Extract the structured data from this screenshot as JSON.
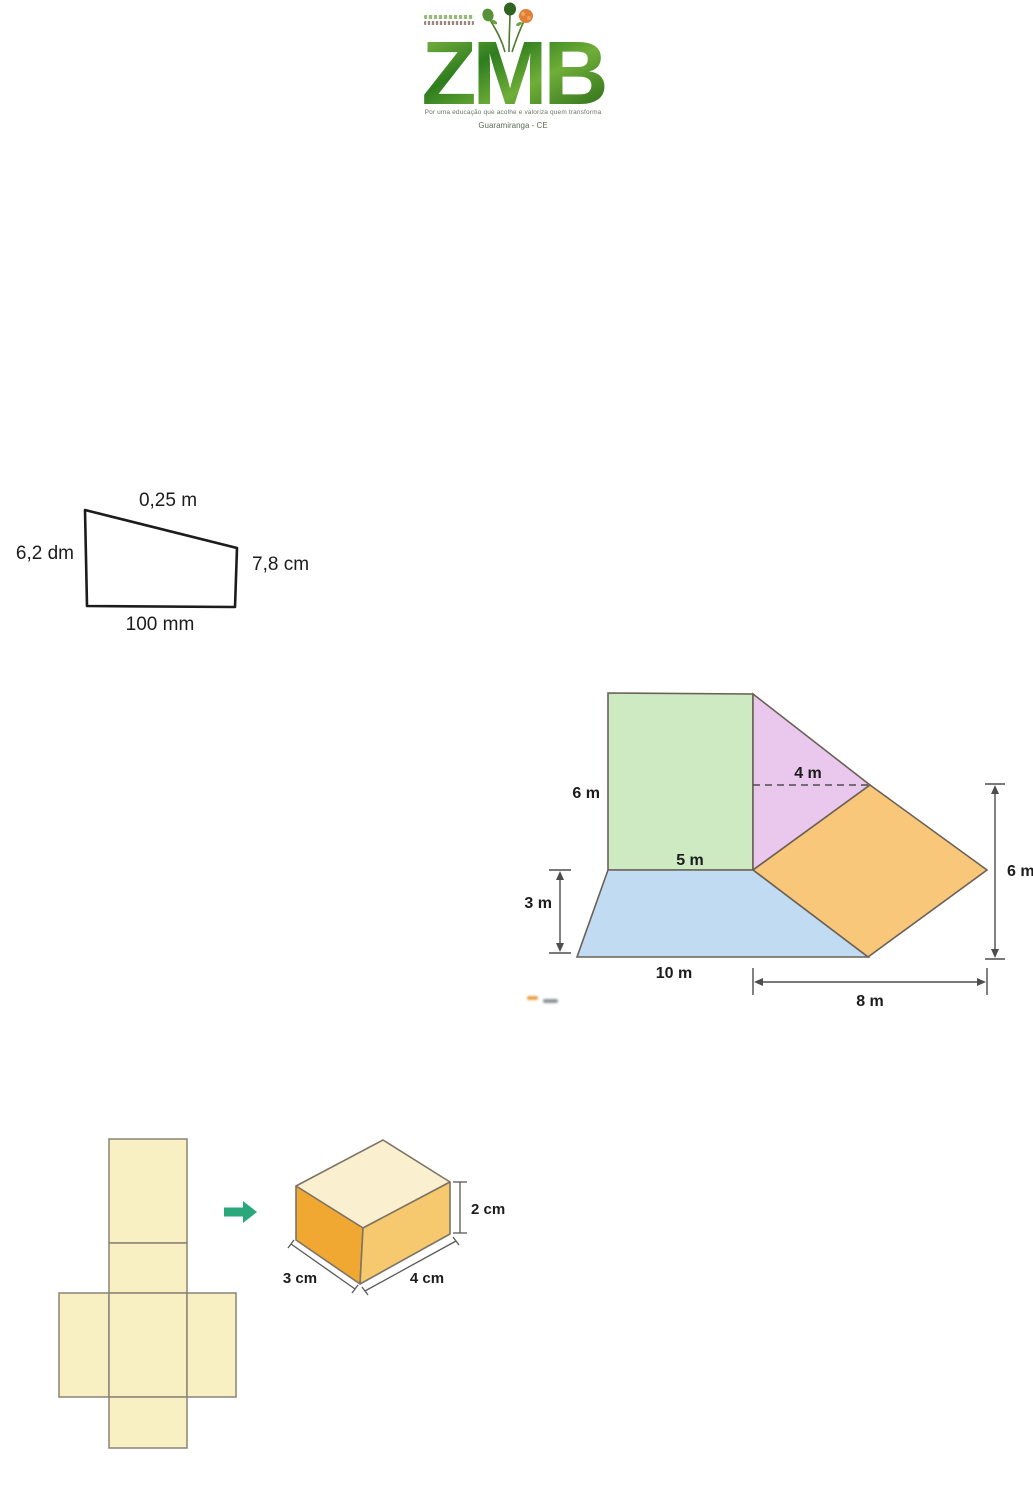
{
  "logo": {
    "name": "ZMB",
    "tagline": "Por uma educação que acolhe e valoriza quem transforma",
    "location": "Guaramiranga - CE"
  },
  "trapezoid_figure": {
    "side_top": "0,25 m",
    "side_left": "6,2 dm",
    "side_right": "7,8 cm",
    "side_bottom": "100 mm"
  },
  "composite_figure": {
    "square_height": "6 m",
    "square_base": "5 m",
    "triangle_width": "4 m",
    "trapezoid_height": "3 m",
    "trapezoid_base": "10 m",
    "right_height": "6 m",
    "bottom_width": "8 m",
    "colors": {
      "square": "#cdeac3",
      "triangle": "#eac7ed",
      "parallelogram": "#f9c77a",
      "trapezoid": "#c1dcf2"
    }
  },
  "net_figure": {
    "box_height": "2 cm",
    "box_depth": "3 cm",
    "box_width": "4 cm",
    "colors": {
      "net_fill": "#f8efc2",
      "box_top": "#faf0cf",
      "box_left": "#f0a832",
      "box_right": "#f6c96e",
      "arrow": "#2aa87c"
    }
  }
}
